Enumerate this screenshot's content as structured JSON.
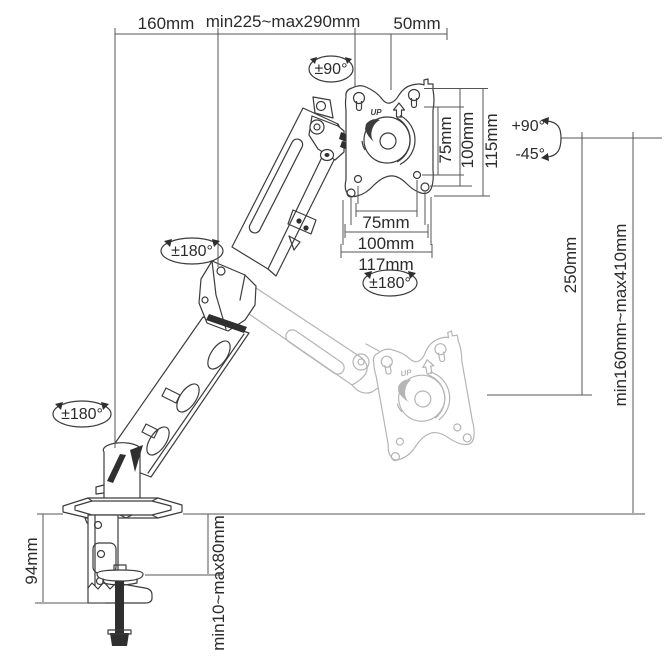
{
  "diagram": {
    "title": "monitor-arm-dimension-drawing",
    "units": "mm",
    "dimensions": {
      "top_offset": "160mm",
      "reach_range": "min225~max290mm",
      "head_depth": "50mm",
      "vesa_vertical_75": "75mm",
      "vesa_vertical_100": "100mm",
      "plate_height": "115mm",
      "vesa_horizontal_75": "75mm",
      "vesa_horizontal_100": "100mm",
      "plate_width": "117mm",
      "arm_rise": "250mm",
      "height_range": "min160mm~max410mm",
      "clamp_height": "94mm",
      "desk_thickness_range": "min10~max80mm"
    },
    "rotations": {
      "head_swivel": "±90°",
      "tilt_up": "+90°",
      "tilt_down": "-45°",
      "elbow_rotation": "±180°",
      "base_rotation": "±180°",
      "plate_rotation": "±180°"
    },
    "plate_label": "UP",
    "colors": {
      "line": "#3c3c3c",
      "dimension_line": "#555555",
      "ghost_line": "#b5b5b5",
      "screw_fill": "#1a1a1a",
      "background": "#ffffff"
    }
  }
}
